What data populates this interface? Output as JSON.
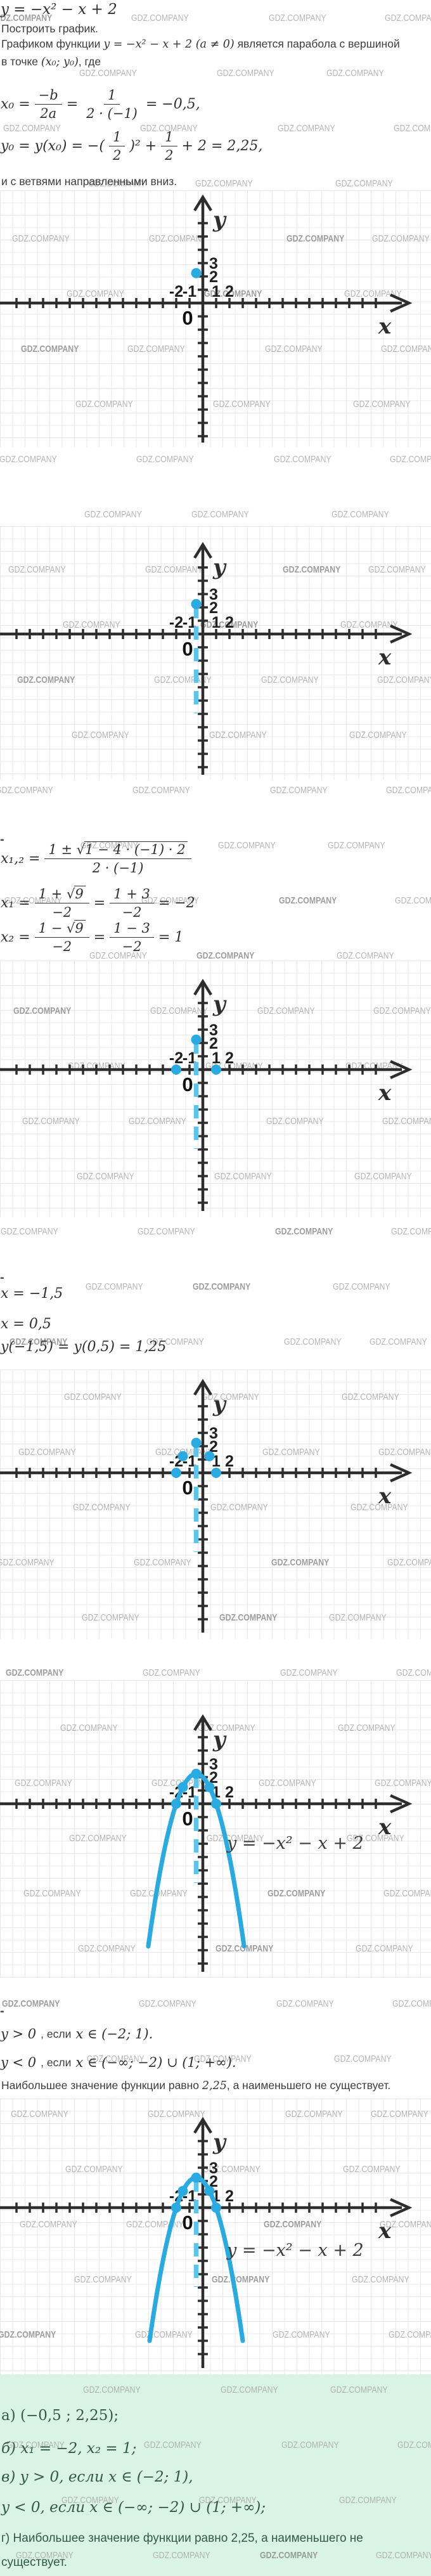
{
  "watermark": {
    "text": "GDZ.COMPANY"
  },
  "colors": {
    "accent_blue": "#29abe2",
    "dashed_blue": "#5fc4ec",
    "axis": "#2d2d2d",
    "grid": "#e5e9eb",
    "watermark": "#a9a9a9",
    "answer_bg": "#d9f3e5",
    "answer_text": "#33594a"
  },
  "intro": {
    "equation": "y = −x² − x + 2",
    "task": "Построить график.",
    "graph_desc": {
      "t1": "Графиком функции ",
      "m": "y = −x² − x + 2 (a ≠ 0)",
      "t2": " является парабола с вершиной"
    },
    "vertex_point": {
      "t1": "в точке ",
      "m": "(x₀; y₀)",
      "t2": ", где"
    },
    "branches": "и с ветвями направленными вниз."
  },
  "formulas": {
    "x0": {
      "lhs": "x₀ =",
      "f1n": "−b",
      "f1d": "2a",
      "eq": "=",
      "f2n": "1",
      "f2d": "2 · (−1)",
      "res": "= −0,5,"
    },
    "y0": {
      "p1": "y₀ = y(x₀) = −(",
      "f1n": "1",
      "f1d": "2",
      "p2": ")² +",
      "f2n": "1",
      "f2d": "2",
      "p3": "+ 2 = 2,25,"
    },
    "x12": {
      "lhs": "x₁,₂ =",
      "numpre": "1 ± √",
      "rad": "1 − 4 · (−1) · 2",
      "den": "2 · (−1)"
    },
    "x1": {
      "lhs": "x₁ =",
      "f1pre": "1 + √",
      "f1rad": "9",
      "f1d": "−2",
      "eq": "=",
      "f2n": "1 + 3",
      "f2d": "−2",
      "res": "= −2"
    },
    "x2": {
      "lhs": "x₂ =",
      "f1pre": "1 − √",
      "f1rad": "9",
      "f1d": "−2",
      "eq": "=",
      "f2n": "1 − 3",
      "f2d": "−2",
      "res": "= 1"
    },
    "dash": "-"
  },
  "mid": {
    "x_left": "x = −1,5",
    "x_right": "x = 0,5",
    "y_vals": "y(−1,5) = y(0,5) = 1,25"
  },
  "conclusion": {
    "pos": {
      "m1": "y > 0",
      "t": ", если ",
      "m2": "x ∈ (−2; 1)."
    },
    "neg": {
      "m1": "y < 0",
      "t": ", если ",
      "m2": "x ∈ (−∞; −2) ∪ (1; +∞)."
    },
    "max": {
      "t1": "Наибольшее значение функции равно ",
      "m": "2,25",
      "t2": ", а наименьшего не существует."
    }
  },
  "answers": {
    "a": "а) (−0,5 ; 2,25);",
    "b": "б) x₁ = −2, x₂ = 1;",
    "v": "в) y > 0, если x ∈ (−2; 1),",
    "v2": "y < 0, если x ∈ (−∞; −2) ∪ (1; +∞);",
    "g1": "г) Наибольшее значение функции равно 2,25, а наименьшего не",
    "g2": "существует."
  },
  "axes": {
    "xlabel": "x",
    "ylabel": "y",
    "origin_label": "0",
    "xtick_labels": [
      "-2",
      "-1",
      "1",
      "2"
    ],
    "xtick_values": [
      -2,
      -1,
      1,
      2
    ],
    "ytick_labels": [
      "2",
      "3"
    ],
    "ytick_values": [
      2,
      3
    ]
  },
  "chart_data": [
    {
      "name": "vertex-plot",
      "type": "scatter",
      "function": "y = −x² − x + 2",
      "points": [
        [
          -0.5,
          2.25
        ]
      ],
      "symmetry_axis": false,
      "curve": false,
      "equation_label": ""
    },
    {
      "name": "symmetry-axis-plot",
      "type": "scatter",
      "function": "y = −x² − x + 2",
      "points": [
        [
          -0.5,
          2.25
        ]
      ],
      "symmetry_axis": true,
      "symmetry_axis_x": -0.5,
      "curve": false,
      "equation_label": ""
    },
    {
      "name": "roots-plot",
      "type": "scatter",
      "function": "y = −x² − x + 2",
      "points": [
        [
          -0.5,
          2.25
        ],
        [
          -2,
          0
        ],
        [
          1,
          0
        ]
      ],
      "symmetry_axis": true,
      "symmetry_axis_x": -0.5,
      "curve": false,
      "equation_label": ""
    },
    {
      "name": "extra-points-plot",
      "type": "scatter",
      "function": "y = −x² − x + 2",
      "points": [
        [
          -0.5,
          2.25
        ],
        [
          -1.5,
          1.25
        ],
        [
          0.5,
          1.25
        ],
        [
          -2,
          0
        ],
        [
          1,
          0
        ]
      ],
      "symmetry_axis": true,
      "symmetry_axis_x": -0.5,
      "curve": false,
      "equation_label": ""
    },
    {
      "name": "parabola-plot",
      "type": "line",
      "function": "y = −x² − x + 2",
      "points": [
        [
          -0.5,
          2.25
        ],
        [
          -1.5,
          1.25
        ],
        [
          0.5,
          1.25
        ],
        [
          -2,
          0
        ],
        [
          1,
          0
        ]
      ],
      "symmetry_axis": true,
      "symmetry_axis_x": -0.5,
      "curve": true,
      "curve_domain": [
        -4.1,
        3.1
      ],
      "equation_label": "y = −x² − x + 2"
    },
    {
      "name": "final-parabola-plot",
      "type": "line",
      "function": "y = −x² − x + 2",
      "points": [
        [
          -0.5,
          2.25
        ],
        [
          -1.5,
          1.25
        ],
        [
          0.5,
          1.25
        ],
        [
          -2,
          0
        ],
        [
          1,
          0
        ]
      ],
      "symmetry_axis": true,
      "symmetry_axis_x": -0.5,
      "curve": true,
      "curve_domain": [
        -4.0,
        3.0
      ],
      "equation_label": "y = −x² − x + 2"
    }
  ]
}
